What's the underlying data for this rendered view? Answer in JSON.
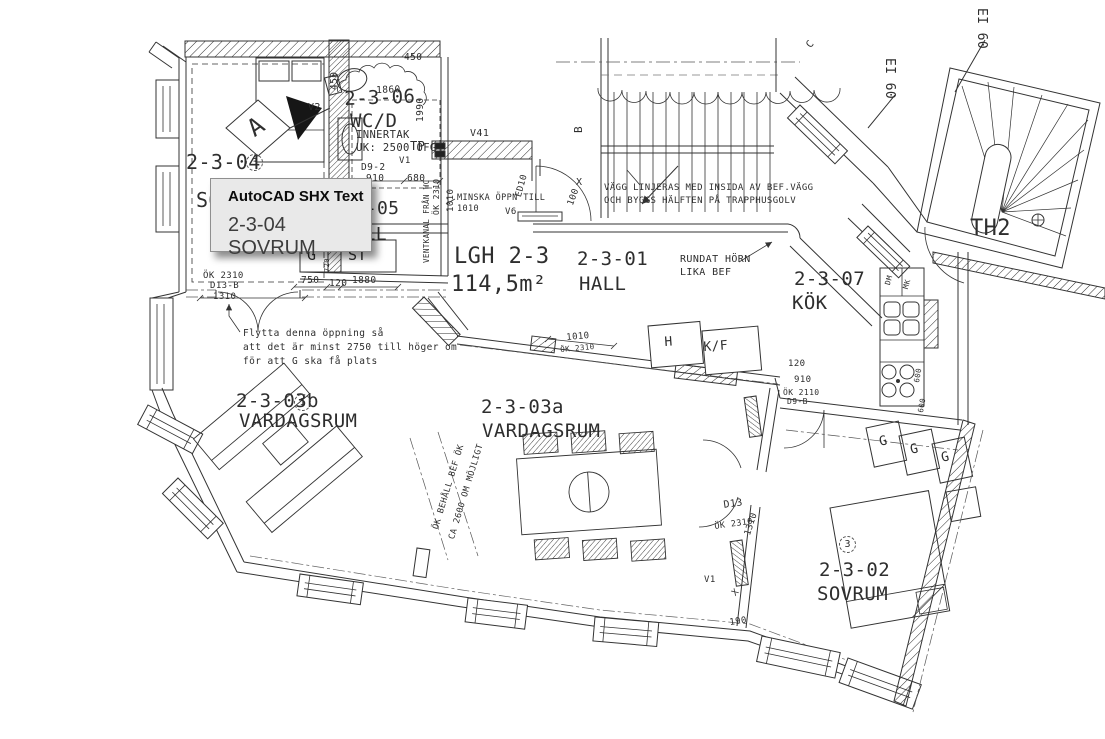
{
  "tooltip": {
    "title": "AutoCAD SHX Text",
    "value": "2-3-04 SOVRUM"
  },
  "colors": {
    "line": "#333333",
    "dashdot": "#555555",
    "tooltip_bg": "#e9e9e9",
    "tooltip_border": "#8f8f8f"
  },
  "apartment": {
    "label": "LGH 2-3",
    "area": "114,5m²"
  },
  "rooms": [
    {
      "number": "2-3-01",
      "name": "HALL"
    },
    {
      "number": "2-3-02",
      "name": "SOVRUM"
    },
    {
      "number": "2-3-03a",
      "name": "VARDAGSRUM"
    },
    {
      "number": "2-3-03b",
      "name": "VARDAGSRUM"
    },
    {
      "number": "2-3-04",
      "name": "SOVRUM"
    },
    {
      "number": "2-3-05",
      "name": "HALL"
    },
    {
      "number": "2-3-06",
      "name": "WC/D"
    },
    {
      "number": "2-3-07",
      "name": "KÖK"
    },
    {
      "number": "TH2",
      "name": "TRAPPHUS"
    }
  ],
  "labels": [
    {
      "n": "room-2304-number",
      "t": "2-3-04",
      "x": 186,
      "y": 152,
      "s": 20
    },
    {
      "n": "room-2304-name",
      "t": "SOVRUM",
      "x": 196,
      "y": 190,
      "s": 20
    },
    {
      "n": "room-2305-number",
      "t": "2-3-05",
      "x": 332,
      "y": 200,
      "s": 18
    },
    {
      "n": "room-2305-name",
      "t": "HALL",
      "x": 342,
      "y": 226,
      "s": 18
    },
    {
      "n": "room-2306-number",
      "t": "2-3-06",
      "x": 344,
      "y": 90,
      "s": 19,
      "r": -2
    },
    {
      "n": "room-wcd-name",
      "t": "WC/D",
      "x": 350,
      "y": 112,
      "s": 19
    },
    {
      "n": "note-innertak",
      "t": "INNERTAK",
      "x": 356,
      "y": 130,
      "s": 10.5
    },
    {
      "n": "note-uk2500",
      "t": "UK: 2500 ÖFG",
      "x": 356,
      "y": 143,
      "s": 10.5
    },
    {
      "n": "code-tp",
      "t": "TP",
      "x": 410,
      "y": 140,
      "s": 12
    },
    {
      "n": "code-v1-wc",
      "t": "V1",
      "x": 399,
      "y": 157,
      "s": 9
    },
    {
      "n": "code-d9-2",
      "t": "D9-2",
      "x": 361,
      "y": 163,
      "s": 9.5
    },
    {
      "n": "dim-910-wc",
      "t": "910",
      "x": 366,
      "y": 174,
      "s": 9.5
    },
    {
      "n": "dim-680",
      "t": "680",
      "x": 407,
      "y": 174,
      "s": 9.5
    },
    {
      "n": "dim-1990",
      "t": "1990",
      "x": 416,
      "y": 122,
      "s": 9.5,
      "r": -90
    },
    {
      "n": "dim-1860",
      "t": "1860",
      "x": 376,
      "y": 86,
      "s": 9.5,
      "r": -2
    },
    {
      "n": "dim-450-left",
      "t": "450",
      "x": 330,
      "y": 90,
      "s": 9.5,
      "r": -90
    },
    {
      "n": "dim-450-top",
      "t": "450",
      "x": 404,
      "y": 53,
      "s": 9.5
    },
    {
      "n": "code-v2",
      "t": "V2",
      "x": 308,
      "y": 103,
      "s": 10
    },
    {
      "n": "section-mark-a",
      "t": "A",
      "x": 243,
      "y": 121,
      "s": 24,
      "r": -35
    },
    {
      "n": "code-v41",
      "t": "V41",
      "x": 470,
      "y": 129,
      "s": 10
    },
    {
      "n": "note-minska-1",
      "t": "MINSKA ÖPPN TILL",
      "x": 457,
      "y": 194,
      "s": 8.5
    },
    {
      "n": "note-minska-2",
      "t": "1010",
      "x": 457,
      "y": 205,
      "s": 8.5
    },
    {
      "n": "dim-1010-vert",
      "t": "1010",
      "x": 447,
      "y": 212,
      "s": 9,
      "r": -90
    },
    {
      "n": "code-ok2310-vert",
      "t": "ÖK 2310",
      "x": 433,
      "y": 215,
      "s": 8,
      "r": -90
    },
    {
      "n": "note-ventkanal",
      "t": "VENTKANAL FRÅN WC",
      "x": 423,
      "y": 263,
      "s": 7.5,
      "r": -90
    },
    {
      "n": "code-ed10",
      "t": "ED10",
      "x": 515,
      "y": 196,
      "s": 9,
      "r": -75
    },
    {
      "n": "code-v6",
      "t": "V6",
      "x": 505,
      "y": 208,
      "s": 9
    },
    {
      "n": "dim-100",
      "t": "100",
      "x": 567,
      "y": 204,
      "s": 9,
      "r": -70
    },
    {
      "n": "x-mark-entry",
      "t": "X",
      "x": 576,
      "y": 178,
      "s": 10
    },
    {
      "n": "apartment-label",
      "t": "LGH 2-3",
      "x": 454,
      "y": 246,
      "s": 22
    },
    {
      "n": "apartment-area",
      "t": "114,5m²",
      "x": 451,
      "y": 274,
      "s": 22
    },
    {
      "n": "room-2301-number",
      "t": "2-3-01",
      "x": 577,
      "y": 250,
      "s": 19
    },
    {
      "n": "room-2301-name",
      "t": "HALL",
      "x": 579,
      "y": 275,
      "s": 19
    },
    {
      "n": "note-vagg-1",
      "t": "VÄGG LINJERAS MED INSIDA AV BEF.VÄGG",
      "x": 604,
      "y": 184,
      "s": 9
    },
    {
      "n": "note-vagg-2",
      "t": "OCH BYGGS HÄLFTEN PÅ TRAPPHUSGOLV",
      "x": 604,
      "y": 197,
      "s": 9
    },
    {
      "n": "note-rundat-1",
      "t": "RUNDAT HÖRN",
      "x": 680,
      "y": 255,
      "s": 10
    },
    {
      "n": "note-rundat-2",
      "t": "LIKA BEF",
      "x": 680,
      "y": 268,
      "s": 10
    },
    {
      "n": "room-2307-number",
      "t": "2-3-07",
      "x": 794,
      "y": 270,
      "s": 19
    },
    {
      "n": "room-2307-name",
      "t": "KÖK",
      "x": 792,
      "y": 294,
      "s": 19
    },
    {
      "n": "grid-mark-b",
      "t": "B",
      "x": 573,
      "y": 133,
      "s": 11,
      "r": -90
    },
    {
      "n": "grid-mark-c",
      "t": "C",
      "x": 805,
      "y": 44,
      "s": 10,
      "r": -50
    },
    {
      "n": "fire-rating-1",
      "t": "EI 60",
      "x": 988,
      "y": 8,
      "s": 13,
      "r": 90
    },
    {
      "n": "fire-rating-2",
      "t": "EI 60",
      "x": 896,
      "y": 58,
      "s": 13,
      "r": 90
    },
    {
      "n": "stairwell-th2",
      "t": "TH2",
      "x": 970,
      "y": 218,
      "s": 22
    },
    {
      "n": "appliance-dm",
      "t": "DM",
      "x": 884,
      "y": 284,
      "s": 7.5,
      "r": -75
    },
    {
      "n": "appliance-mk",
      "t": "MK",
      "x": 902,
      "y": 288,
      "s": 7.5,
      "r": -75
    },
    {
      "n": "dim-600-a",
      "t": "600",
      "x": 913,
      "y": 382,
      "s": 7.5,
      "r": -80
    },
    {
      "n": "dim-600-b",
      "t": "600",
      "x": 917,
      "y": 412,
      "s": 7.5,
      "r": -80
    },
    {
      "n": "dim-120-kok",
      "t": "120",
      "x": 788,
      "y": 360,
      "s": 9
    },
    {
      "n": "dim-910-kok",
      "t": "910",
      "x": 794,
      "y": 376,
      "s": 9
    },
    {
      "n": "code-ok2110",
      "t": "ÖK 2110",
      "x": 783,
      "y": 389,
      "s": 8
    },
    {
      "n": "code-d9-b",
      "t": "D9-B",
      "x": 787,
      "y": 398,
      "s": 8
    },
    {
      "n": "appliance-h",
      "t": "H",
      "x": 664,
      "y": 336,
      "s": 13,
      "r": -4
    },
    {
      "n": "appliance-kf",
      "t": "K/F",
      "x": 703,
      "y": 341,
      "s": 13,
      "r": -4
    },
    {
      "n": "dim-1010-mid",
      "t": "1010",
      "x": 566,
      "y": 334,
      "s": 9,
      "r": -5
    },
    {
      "n": "code-ok2310-mid",
      "t": "ÖK 2310",
      "x": 560,
      "y": 346,
      "s": 7.5,
      "r": -5
    },
    {
      "n": "note-flytta-1",
      "t": "Flytta denna öppning så",
      "x": 243,
      "y": 329,
      "s": 9.5
    },
    {
      "n": "note-flytta-2",
      "t": "att det är minst 2750 till höger om",
      "x": 243,
      "y": 343,
      "s": 9.5
    },
    {
      "n": "note-flytta-3",
      "t": "för att G ska få plats",
      "x": 243,
      "y": 357,
      "s": 9.5
    },
    {
      "n": "code-ok2310-d13b",
      "t": "ÖK 2310",
      "x": 203,
      "y": 272,
      "s": 9
    },
    {
      "n": "code-d13-b",
      "t": "D13-B",
      "x": 210,
      "y": 282,
      "s": 9
    },
    {
      "n": "dim-1310-left",
      "t": "1310",
      "x": 213,
      "y": 293,
      "s": 9
    },
    {
      "n": "dim-750",
      "t": "750",
      "x": 301,
      "y": 276,
      "s": 9.5
    },
    {
      "n": "dim-120",
      "t": "120",
      "x": 329,
      "y": 279,
      "s": 9.5
    },
    {
      "n": "dim-1880",
      "t": "1880",
      "x": 352,
      "y": 276,
      "s": 9.5
    },
    {
      "n": "closet-g-left",
      "t": "G",
      "x": 307,
      "y": 248,
      "s": 15
    },
    {
      "n": "dim-720",
      "t": "720",
      "x": 324,
      "y": 272,
      "s": 7,
      "r": -90
    },
    {
      "n": "closet-st",
      "t": "ST",
      "x": 348,
      "y": 248,
      "s": 15
    },
    {
      "n": "room-2303b-number",
      "t": "2-3-03b",
      "x": 236,
      "y": 392,
      "s": 19
    },
    {
      "n": "room-2303b-name",
      "t": "VARDAGSRUM",
      "x": 239,
      "y": 412,
      "s": 19
    },
    {
      "n": "room-2303a-number",
      "t": "2-3-03a",
      "x": 481,
      "y": 398,
      "s": 19
    },
    {
      "n": "room-2303a-name",
      "t": "VARDAGSRUM",
      "x": 482,
      "y": 422,
      "s": 19
    },
    {
      "n": "note-ok-behall-1",
      "t": "ÖK BEHÅLL BEF ÖK",
      "x": 432,
      "y": 528,
      "s": 8.5,
      "r": -73
    },
    {
      "n": "note-ok-behall-2",
      "t": "CA 2600 OM MÖJLIGT",
      "x": 448,
      "y": 538,
      "s": 8.5,
      "r": -73
    },
    {
      "n": "code-d13",
      "t": "D13",
      "x": 723,
      "y": 501,
      "s": 10,
      "r": -8
    },
    {
      "n": "code-ok2310-right",
      "t": "ÖK 2310",
      "x": 714,
      "y": 523,
      "s": 8.5,
      "r": -8
    },
    {
      "n": "dim-1310-right",
      "t": "1310",
      "x": 744,
      "y": 534,
      "s": 9,
      "r": -72
    },
    {
      "n": "code-v1-right",
      "t": "V1",
      "x": 704,
      "y": 576,
      "s": 9
    },
    {
      "n": "x-mark-wall",
      "t": "X",
      "x": 731,
      "y": 592,
      "s": 9,
      "r": -45
    },
    {
      "n": "dim-190",
      "t": "190",
      "x": 729,
      "y": 619,
      "s": 9,
      "r": -8
    },
    {
      "n": "room-2302-number",
      "t": "2-3-02",
      "x": 819,
      "y": 561,
      "s": 19
    },
    {
      "n": "room-2302-name",
      "t": "SOVRUM",
      "x": 817,
      "y": 585,
      "s": 19
    },
    {
      "n": "wardrobe-g1",
      "t": "G",
      "x": 878,
      "y": 436,
      "s": 13,
      "r": -12
    },
    {
      "n": "wardrobe-g2",
      "t": "G",
      "x": 909,
      "y": 444,
      "s": 13,
      "r": -12
    },
    {
      "n": "wardrobe-g3",
      "t": "G",
      "x": 940,
      "y": 452,
      "s": 13,
      "r": -12
    },
    {
      "n": "ref-bubble-3a",
      "t": "3",
      "x": 246,
      "y": 154,
      "s": 10,
      "c": "circled"
    },
    {
      "n": "ref-bubble-1",
      "t": "1",
      "x": 294,
      "y": 394,
      "s": 10,
      "c": "circled"
    },
    {
      "n": "ref-bubble-3b",
      "t": "3",
      "x": 839,
      "y": 536,
      "s": 10,
      "c": "circled"
    }
  ]
}
